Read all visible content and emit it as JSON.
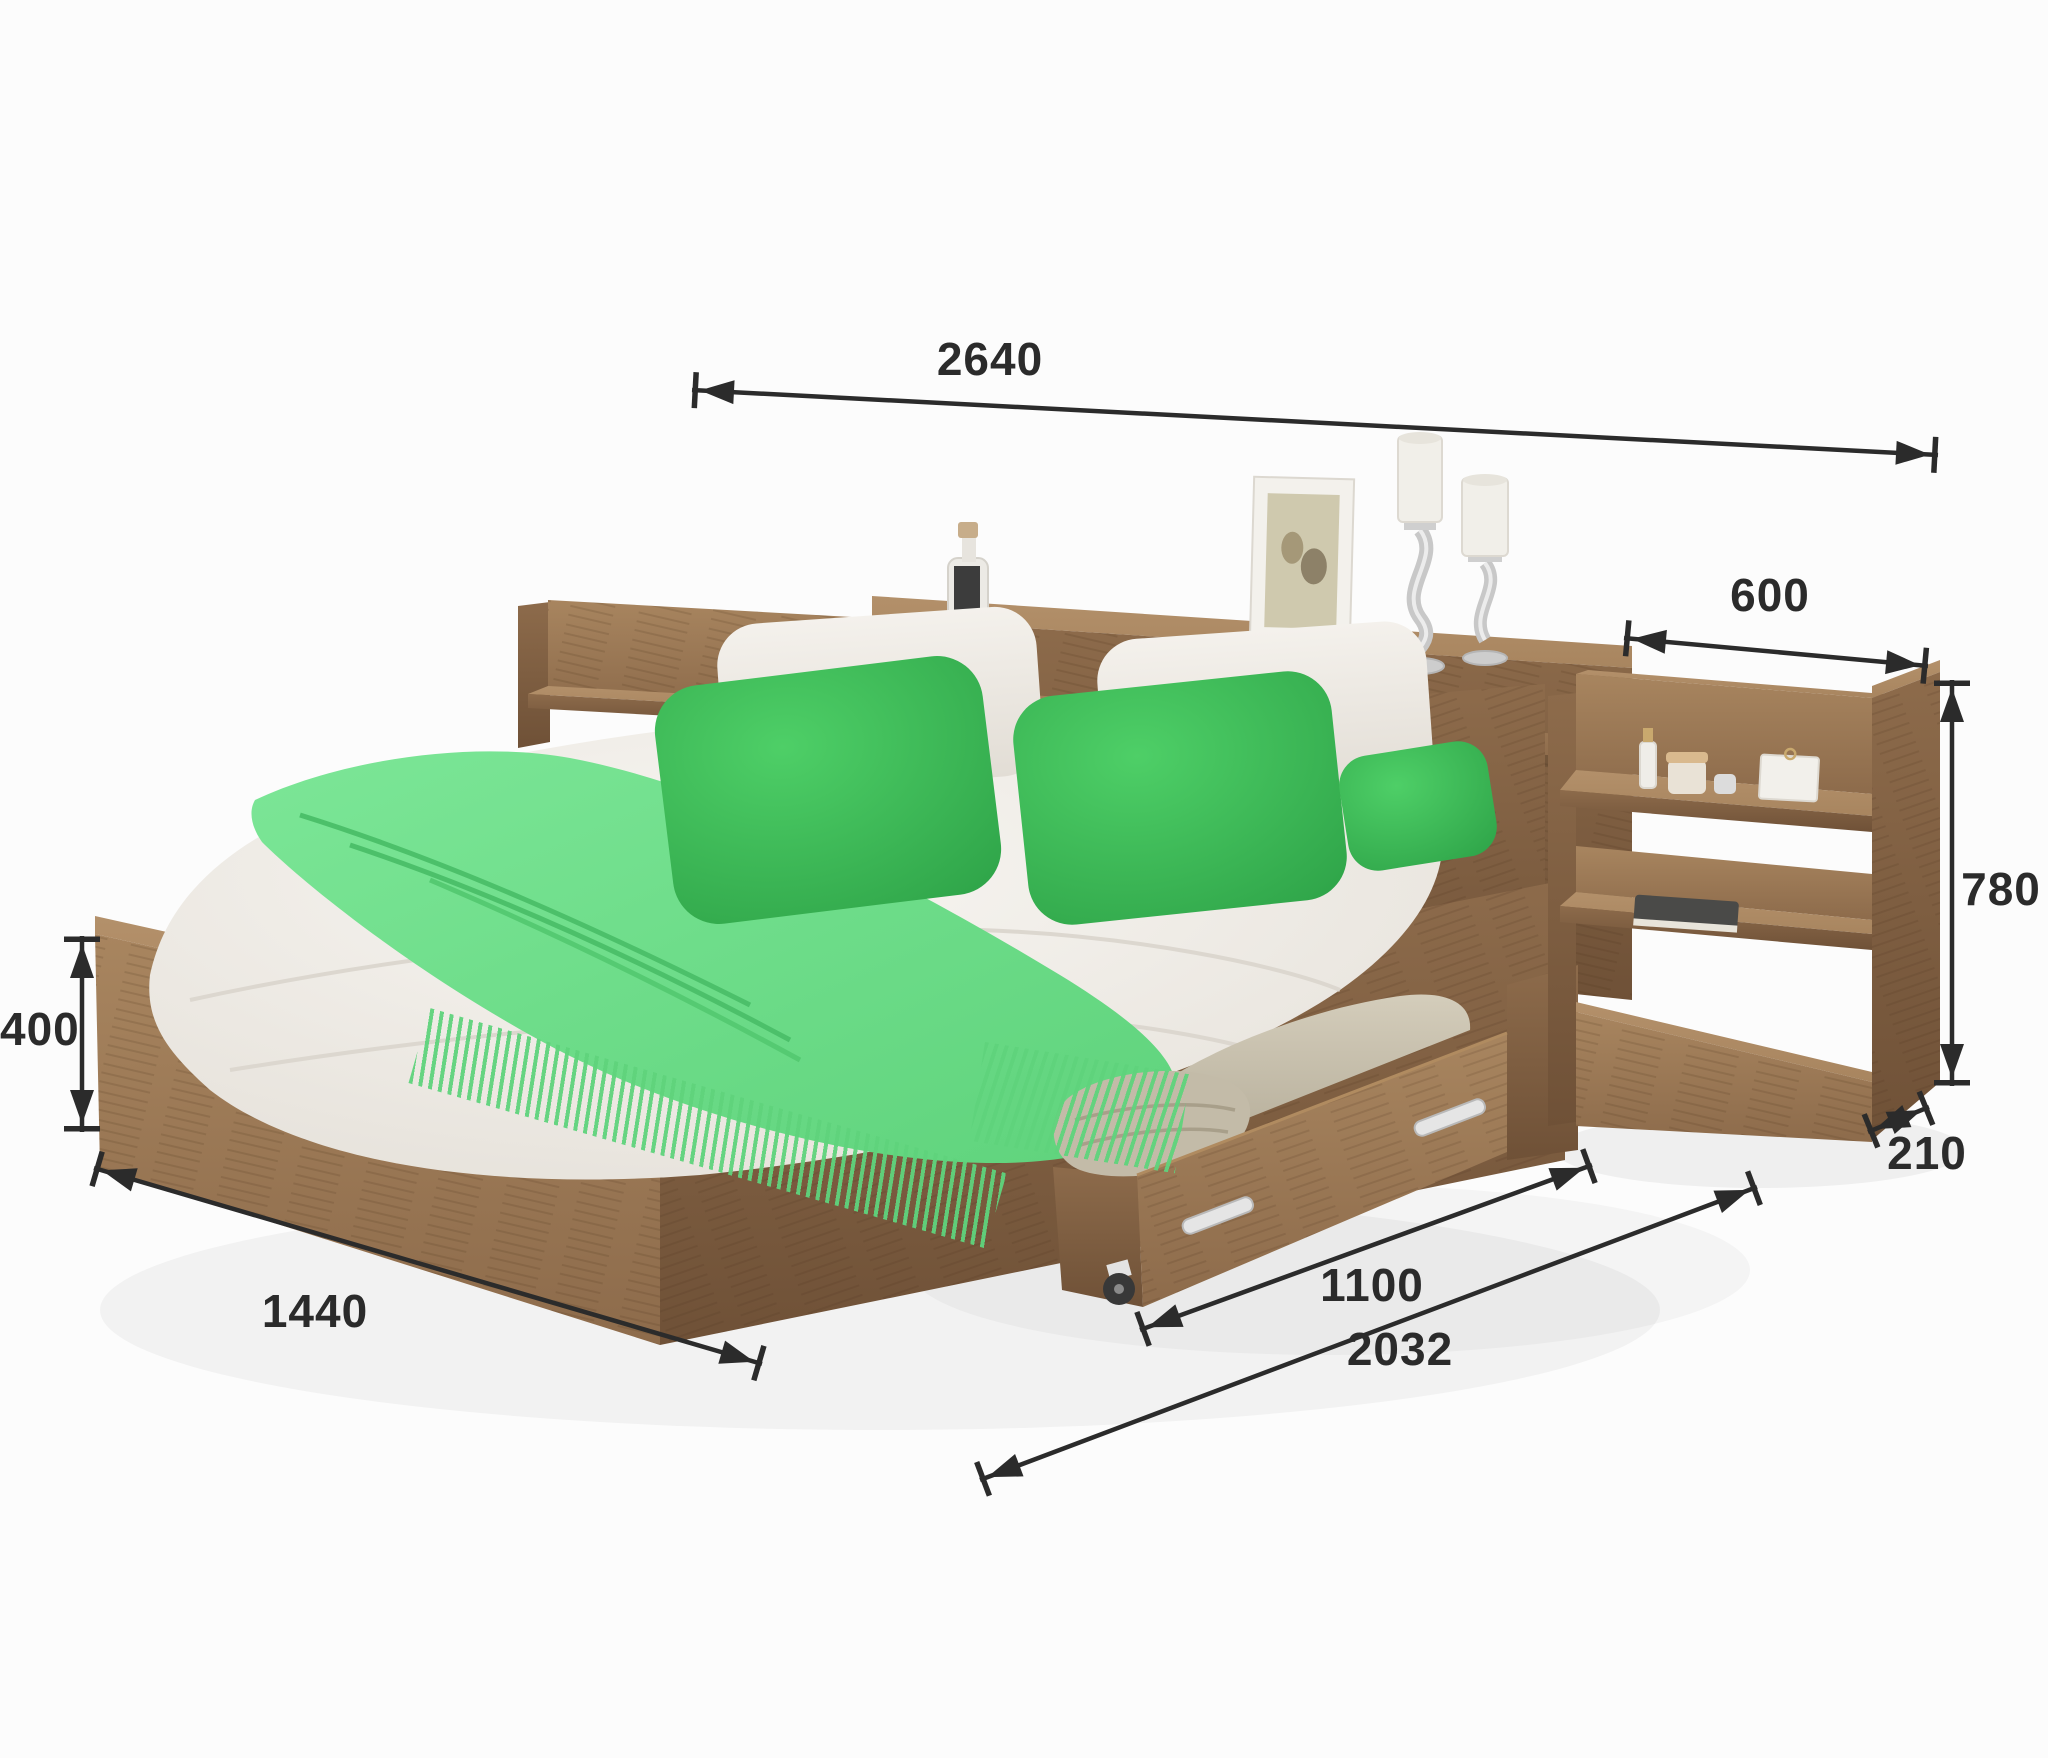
{
  "title": "bed-with-storage-dimension-diagram",
  "dims": {
    "total_width": "2640",
    "nightstand_width": "600",
    "nightstand_height": "780",
    "frame_height": "400",
    "bed_width": "1440",
    "drawer_length": "1100",
    "bed_length": "2032",
    "nightstand_depth": "210"
  },
  "palette": {
    "ink": "#2b2b2b",
    "bg": "#fcfcfc",
    "wood_light": "#a8855f",
    "wood_mid": "#8d6b4b",
    "wood_dark": "#6f5137",
    "wood_top": "#b3906a",
    "green_deep": "#2da247",
    "green_mid": "#4ecf67",
    "green_blanket": "#5fd37c",
    "green_blanket_light": "#7ce697",
    "bedding": "#f4f1ec",
    "bedding_shadow": "#e2ddd5",
    "pad": "#cbc3b0",
    "handle": "#e5e5e5"
  }
}
